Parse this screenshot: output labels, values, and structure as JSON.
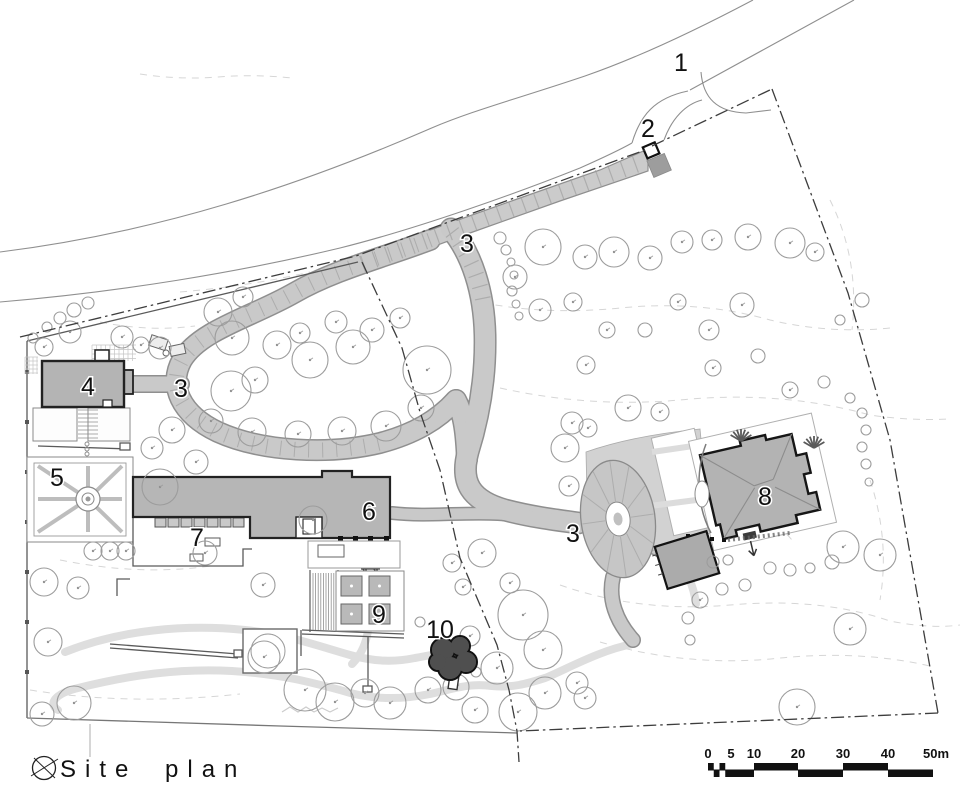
{
  "title": {
    "text": "Site plan"
  },
  "plan_labels": {
    "road": "1",
    "entrance_gate": "2",
    "driveway_upper": "3",
    "driveway_hairpin": "3",
    "driveway_court": "3",
    "building_4": "4",
    "parterre_garden_5": "5",
    "building_6": "6",
    "terrace_7": "7",
    "house_8": "8",
    "garden_9": "9",
    "tree_10": "10"
  },
  "scale_bar": {
    "ticks": [
      "0",
      "5",
      "10",
      "20",
      "30",
      "40",
      "50m"
    ]
  }
}
